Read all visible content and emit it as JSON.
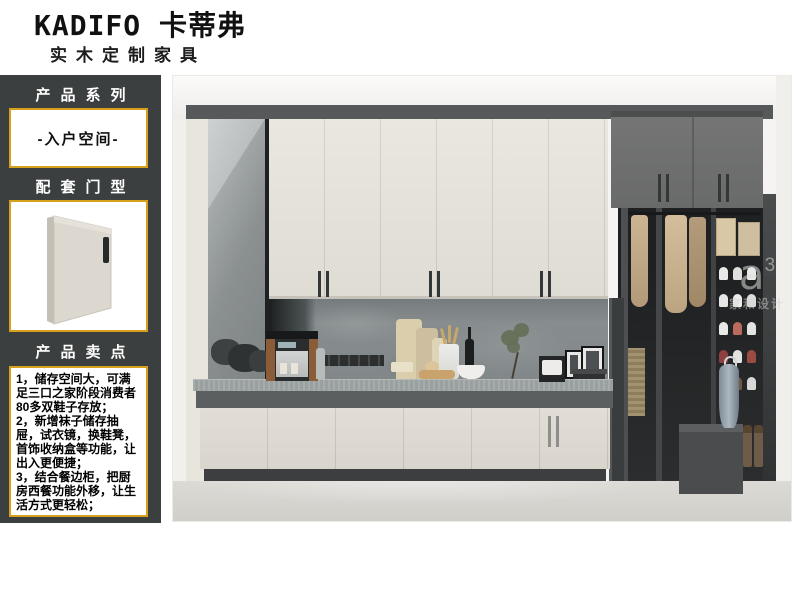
{
  "brand": {
    "logo": "KADIFO 卡蒂弗",
    "tagline": "实木定制家具"
  },
  "sidebar": {
    "panel_color": "#3b3f3f",
    "accent_color": "#d8a11d",
    "series_header": "产品系列",
    "series_value": "-入户空间-",
    "door_header": "配套门型",
    "selling_header": "产品卖点",
    "selling_points": [
      "1，储存空间大，可满足三口之家阶段消费者80多双鞋子存放；",
      "2，新增袜子储存抽屉，试衣镜，换鞋凳，首饰收纳盒等功能，让出入更便捷；",
      "3，结合餐边柜，把厨房西餐功能外移，让生活方式更轻松；"
    ]
  },
  "scene": {
    "watermark": {
      "logo": "a",
      "sup": "3",
      "name": "家和设计"
    }
  }
}
